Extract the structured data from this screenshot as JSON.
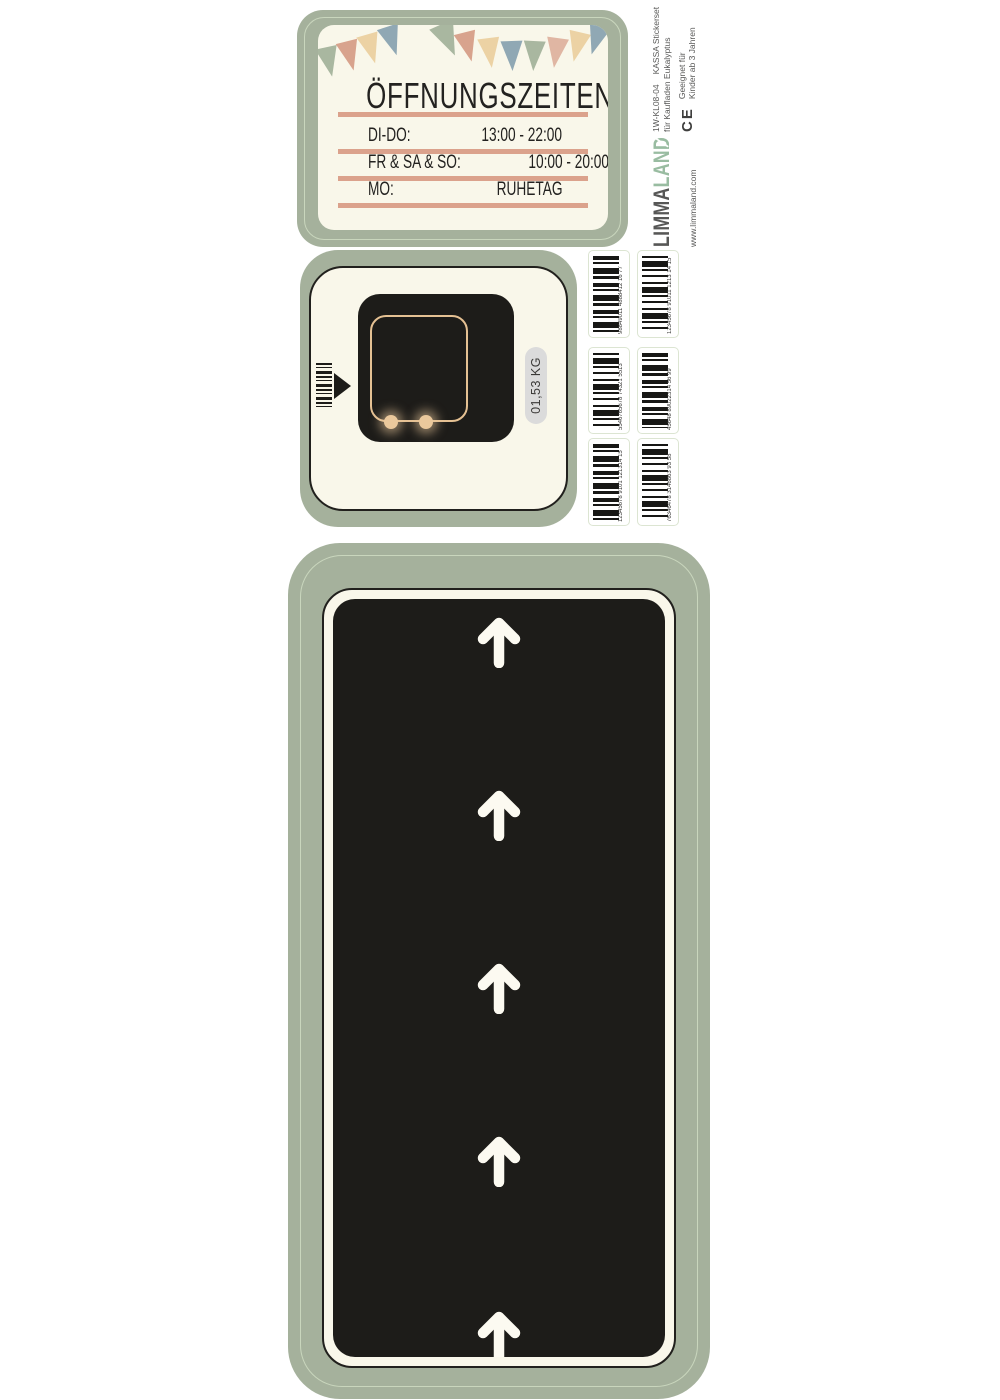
{
  "palette": {
    "sticker_green": "#a5b19c",
    "inner_outline_green": "#c9d6bd",
    "cream": "#f9f7ea",
    "panel_black": "#1d1c19",
    "salmon_bar": "#dba28c",
    "tan_outline": "#e5c193",
    "pill_gray": "#dbdbdb",
    "side_text_gray": "#575756",
    "logo_green": "#99bca1",
    "flag_colors": [
      "#a9b7a0",
      "#d8a38d",
      "#ecd2a4",
      "#90a8b4",
      "#e0b6a3"
    ]
  },
  "opening_hours_sticker": {
    "title": "ÖFFNUNGSZEITEN",
    "rows": [
      {
        "label": "DI-DO:",
        "value": "13:00 - 22:00"
      },
      {
        "label": "FR & SA & SO:",
        "value": "10:00 - 20:00"
      },
      {
        "label": "MO:",
        "value": "RUHETAG"
      }
    ]
  },
  "scale_sticker": {
    "weight": "01,53 KG"
  },
  "barcode_stickers": [
    {
      "number": "98849011 4888412 16 77"
    },
    {
      "number": "12345678 91011 1213 14 15"
    },
    {
      "number": "5546765678 74321 5513"
    },
    {
      "number": "45648 89022314 56 99"
    },
    {
      "number": "12345678 9101 121314 15"
    },
    {
      "number": "76346478 3146863 93 58"
    }
  ],
  "conveyor_sticker": {
    "arrow_count": 5,
    "arrow_direction": "up"
  },
  "side_label": {
    "product_code": "1W-KL08-04",
    "product_name": "KASSA Stickerset",
    "product_desc": "für Kaufladen Eukalyptus",
    "ce_mark": "CE",
    "age_line1": "Geeignet für",
    "age_line2": "Kinder ab 3 Jahren",
    "brand_part1": "LIMMA",
    "brand_part2": "LAND",
    "website": "www.limmaland.com"
  }
}
